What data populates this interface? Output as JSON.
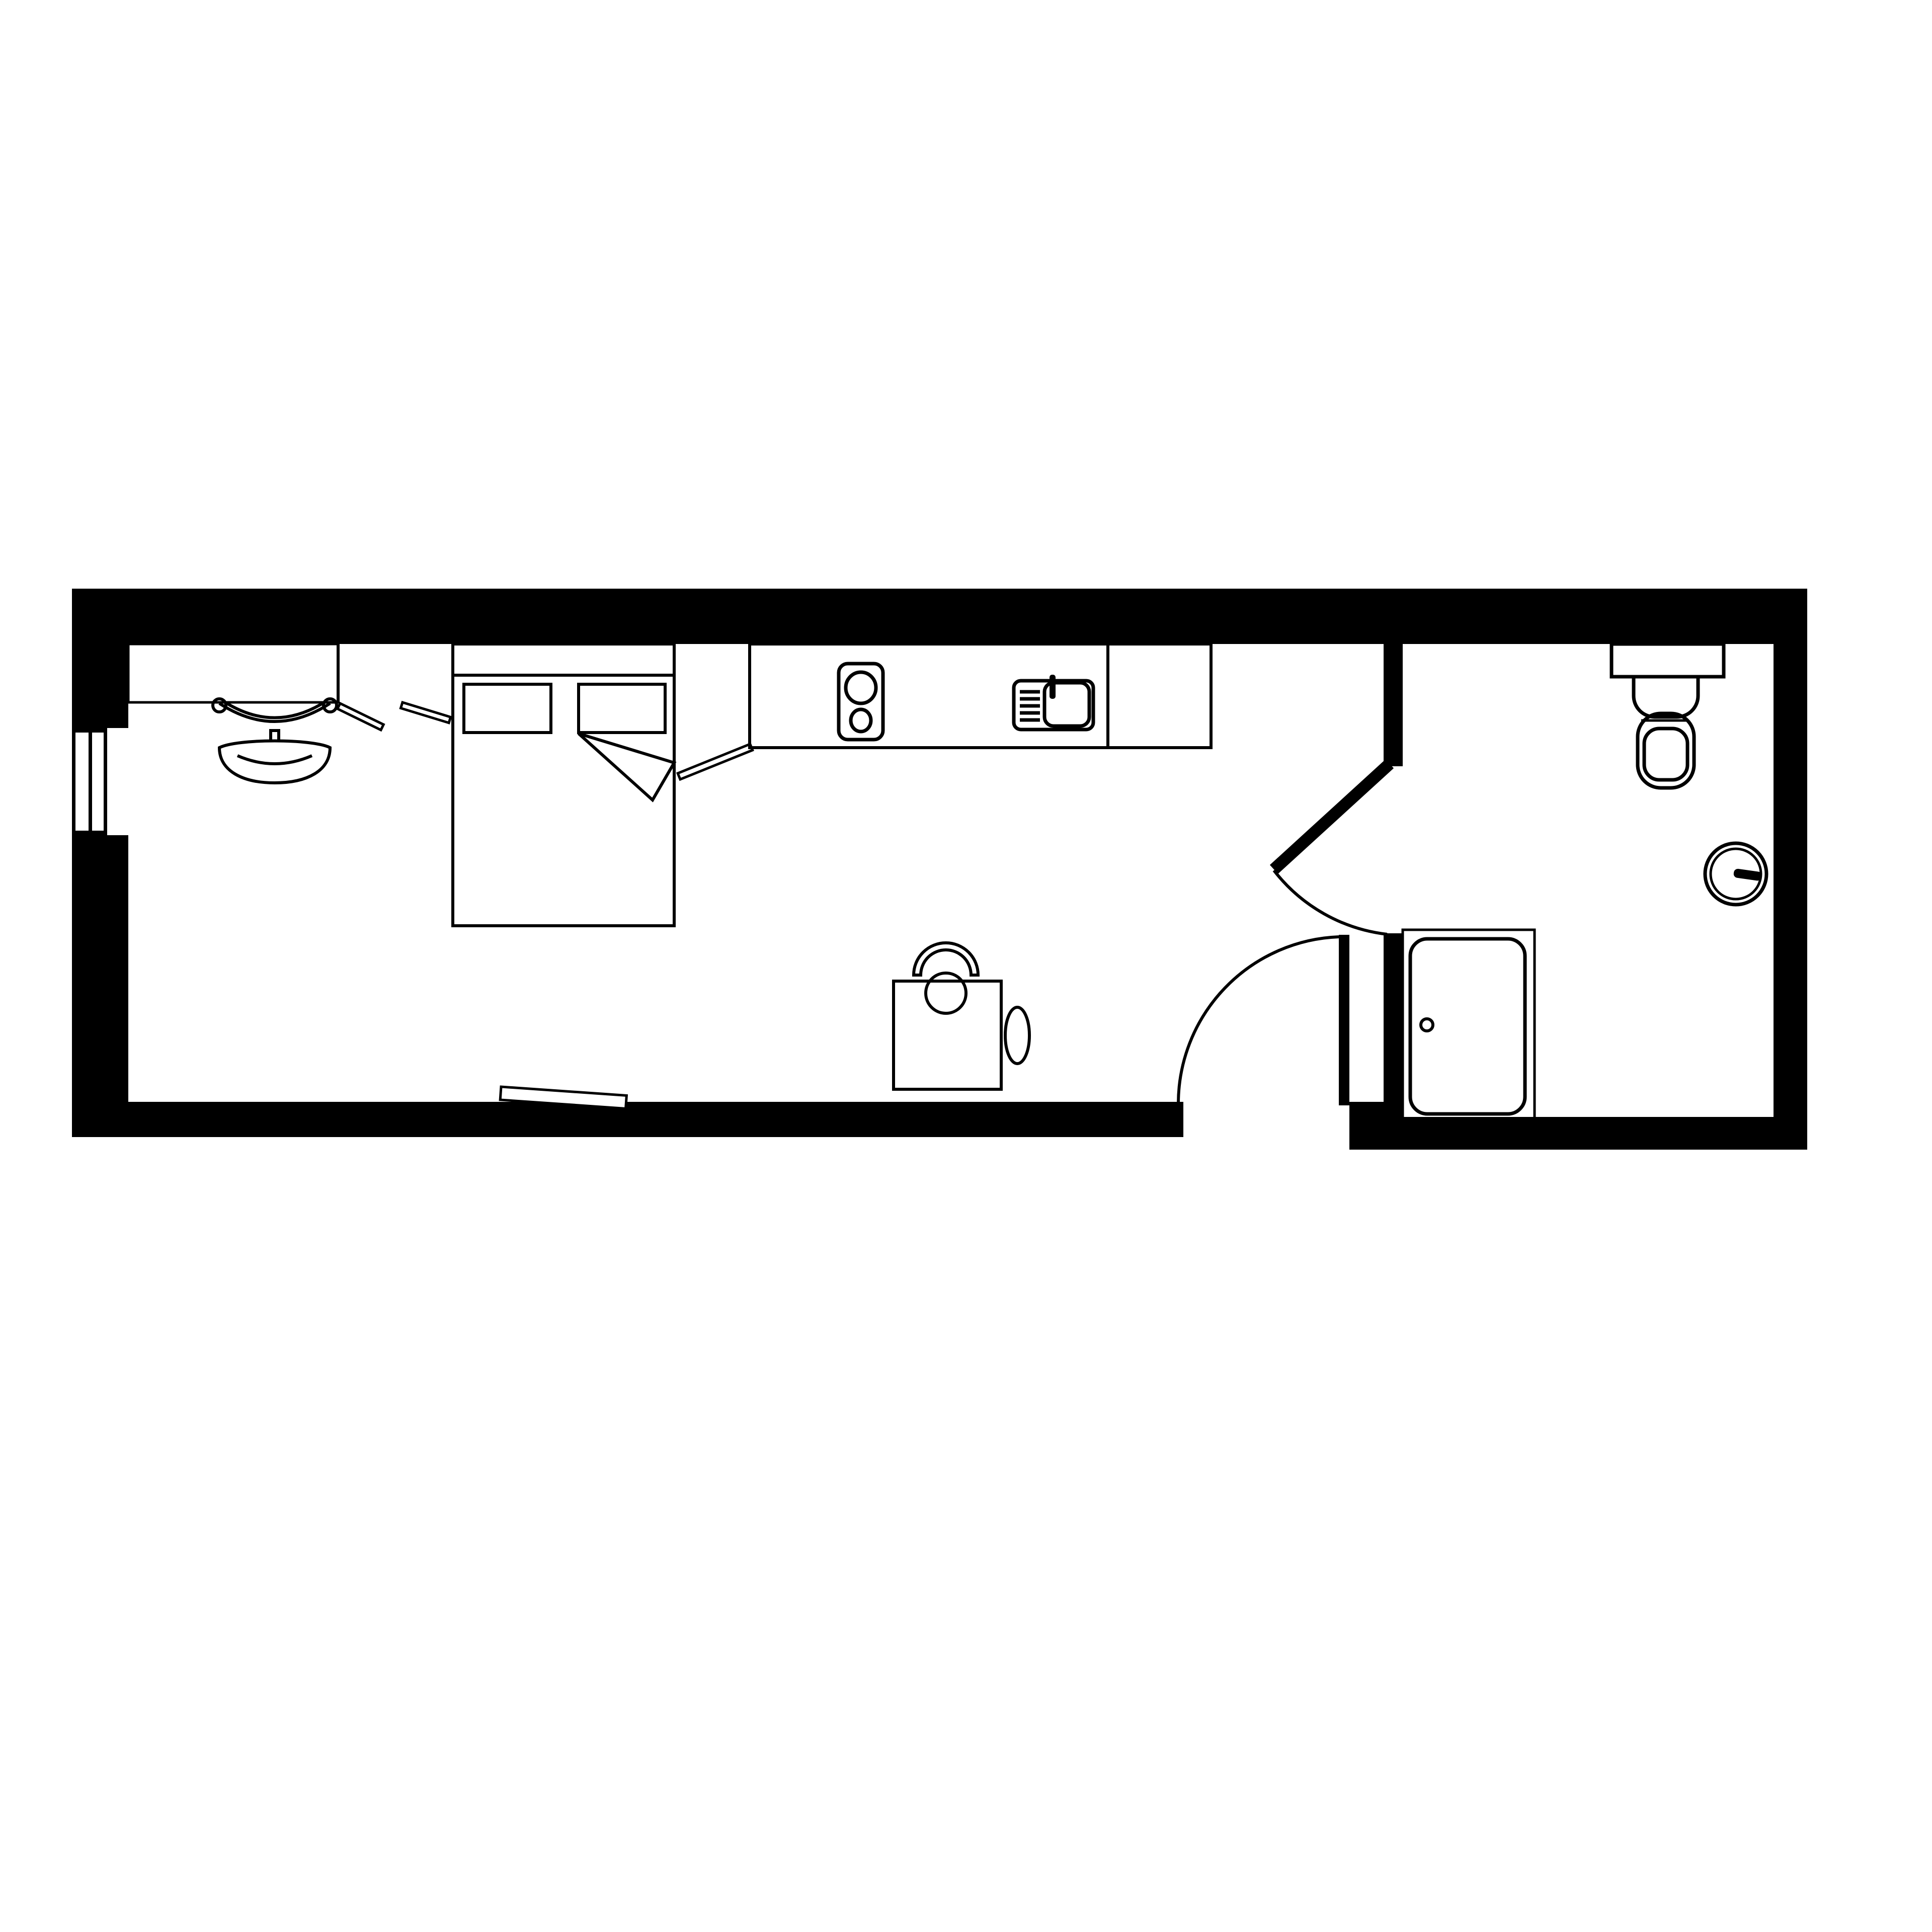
{
  "page": {
    "kind": "architectural-floor-plan",
    "orientation": "landscape-strip"
  },
  "colors": {
    "ink": "#000000",
    "paper": "#ffffff"
  },
  "plan": {
    "rooms": [
      {
        "id": "studio-room",
        "fixtures": [
          "desk",
          "desk-chair",
          "wardrobe-partition",
          "wardrobe-door-left",
          "wardrobe-door-right",
          "double-bed",
          "pillow-left",
          "pillow-right",
          "blanket-fold",
          "kitchen-counter",
          "hob",
          "hob-burner-large",
          "hob-burner-small",
          "sink",
          "sink-basin",
          "sink-tap",
          "sink-drainer",
          "cabinet-flap",
          "dining-table",
          "dining-chair",
          "side-stool",
          "wall-shelf"
        ]
      },
      {
        "id": "bathroom",
        "fixtures": [
          "toilet-cistern",
          "toilet-base",
          "toilet-bowl",
          "wall-clock",
          "shower-enclosure",
          "shower-tray",
          "shower-drain"
        ]
      }
    ],
    "doors": [
      {
        "id": "bathroom-door",
        "state": "open",
        "swing": "arc"
      },
      {
        "id": "entrance-door",
        "state": "open-90",
        "swing": "arc"
      }
    ],
    "windows": [
      {
        "id": "west-window",
        "panes": 2
      }
    ]
  }
}
